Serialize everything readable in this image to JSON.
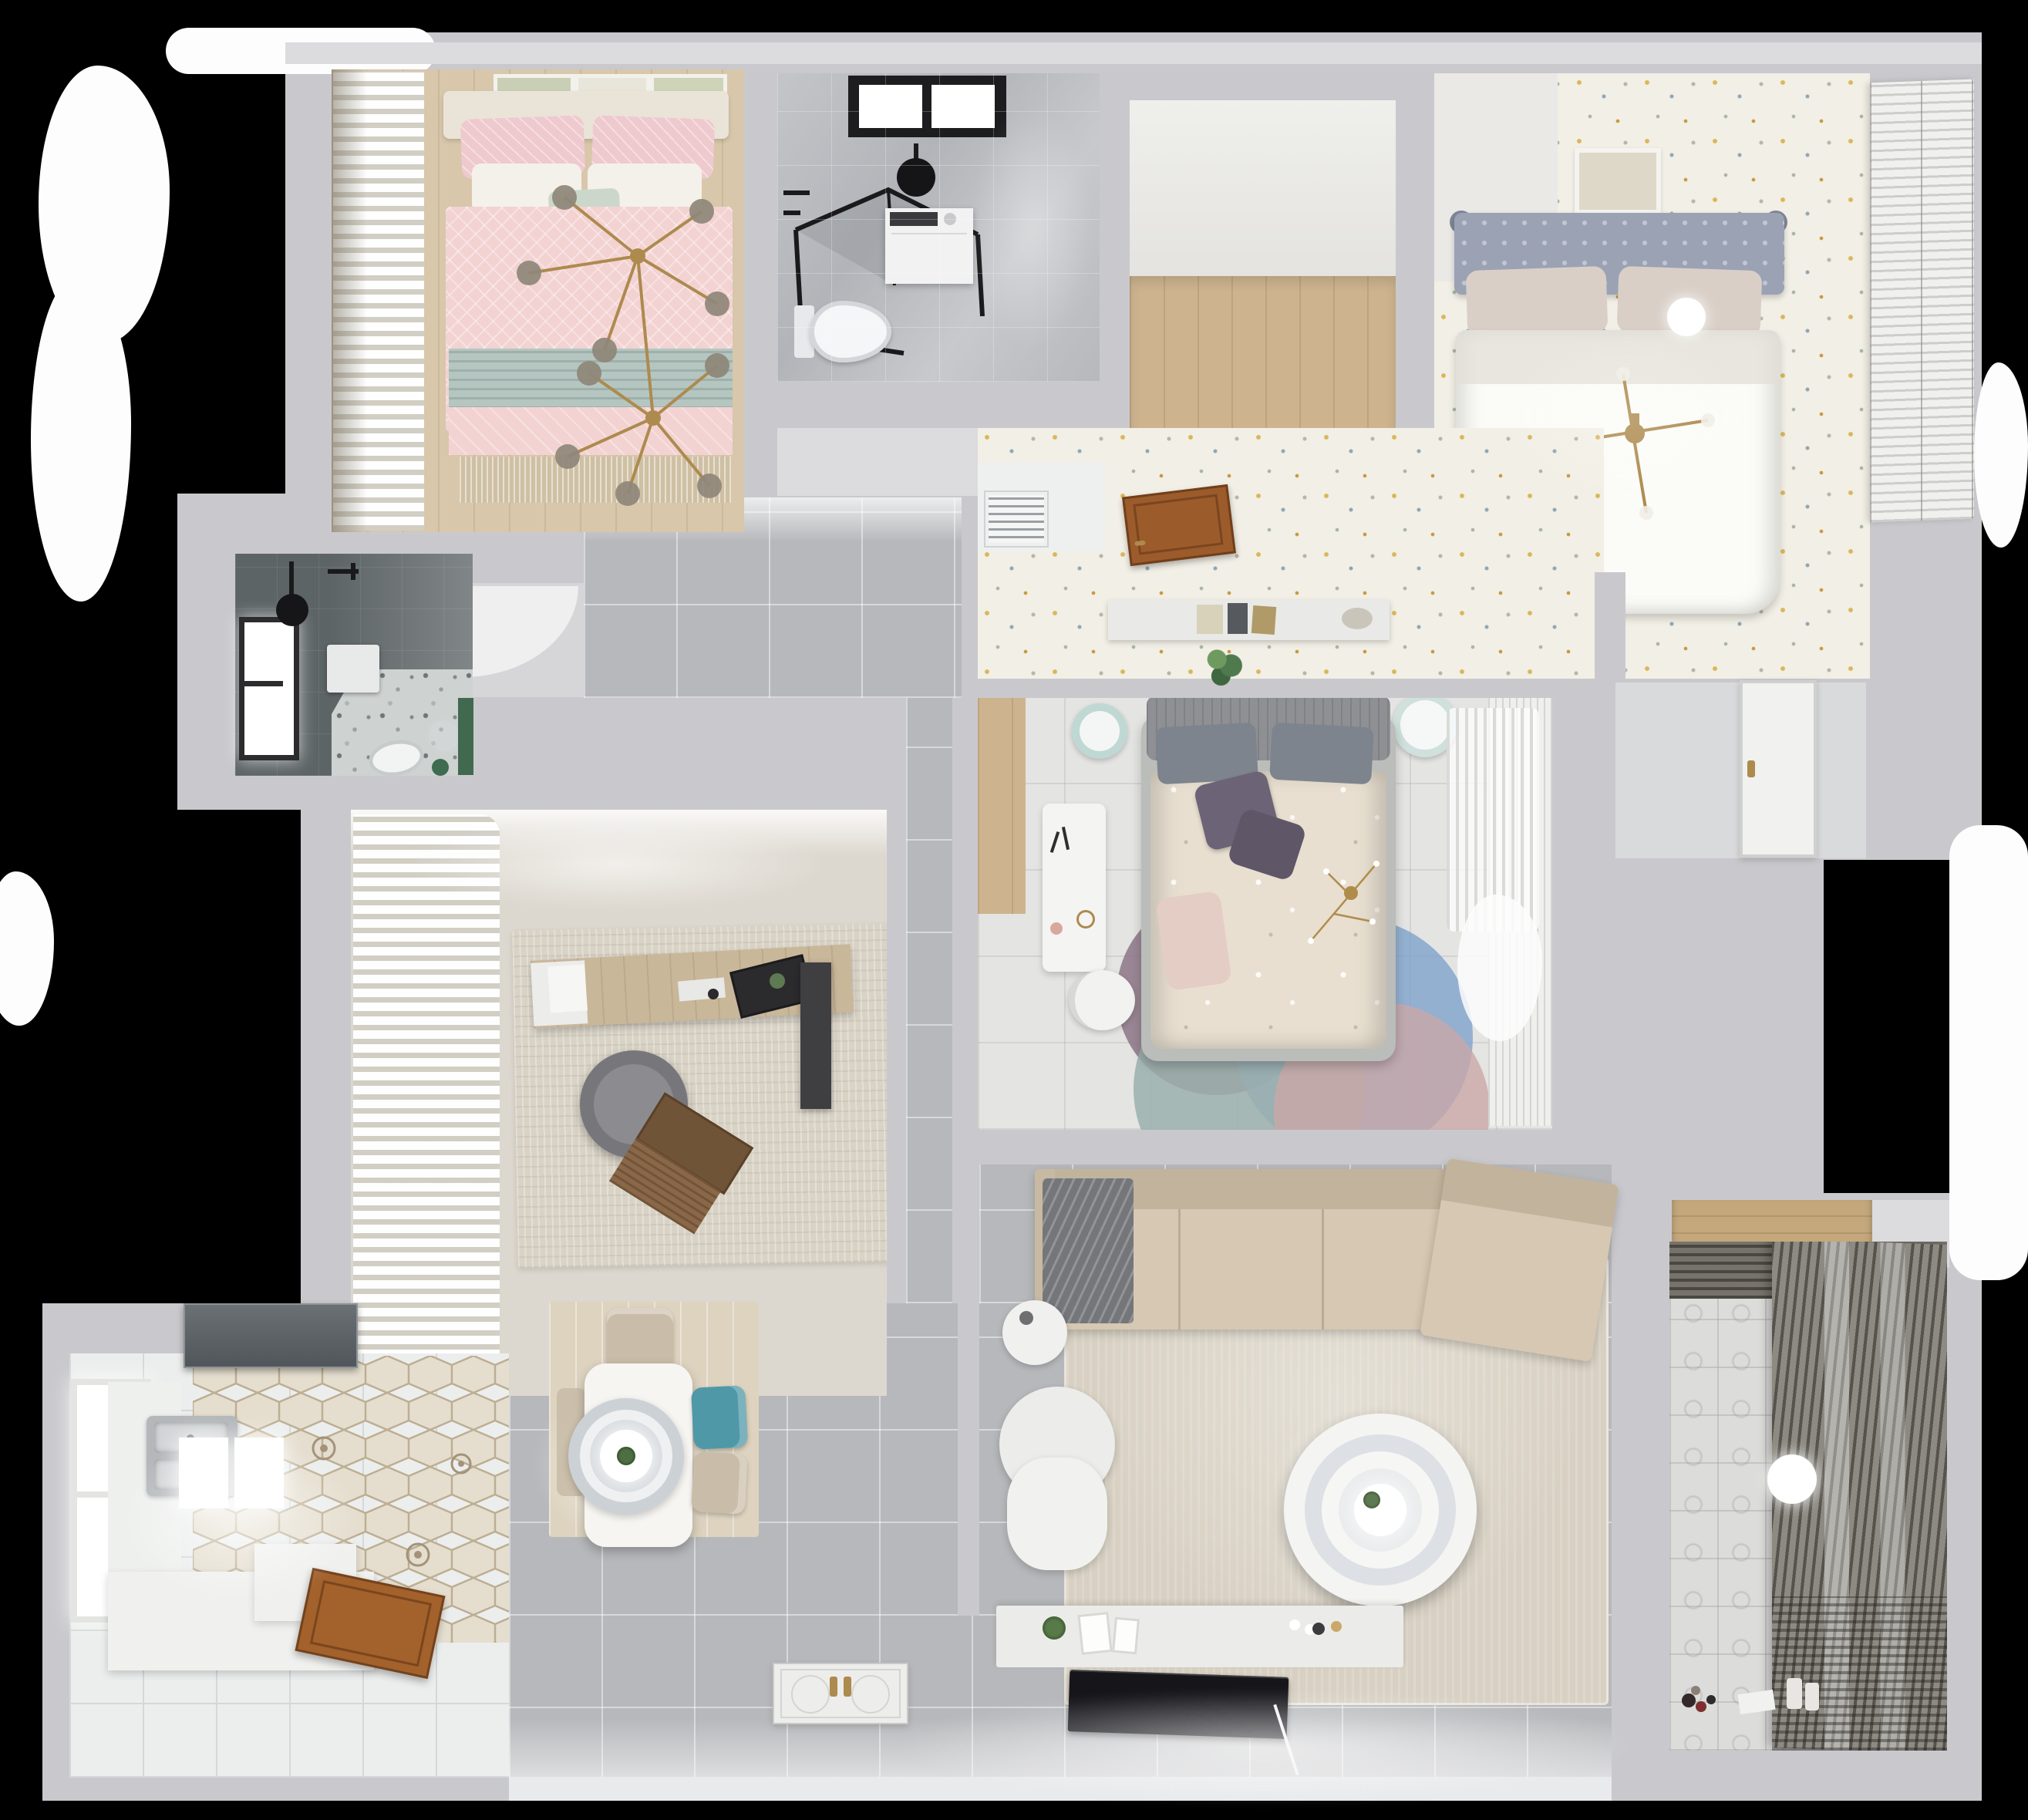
{
  "meta": {
    "title": "3D apartment floor plan, top-down render",
    "view": "top-down",
    "background": "#000000"
  },
  "colors": {
    "bg": "#000000",
    "wall": "#c9c9cd",
    "wallLight": "#dcdcdf",
    "white": "#ffffff",
    "floorGray": "#b7b8bb",
    "speckle": "#f2efe6",
    "woodMid": "#cdb48e",
    "bed1Floor": "#d8c7ab",
    "marbleBase": "#babcc0",
    "blackFrame": "#1d1d1f",
    "pink": "#f3d2d2",
    "pinkDeep": "#eec9ce",
    "tealBlanket": "#b5c6c1",
    "cream": "#f4f1ea",
    "gold": "#ad8a4e",
    "glassBulb": "#8f8779",
    "headboard2": "#9aa2b4",
    "duvet2": "#fbfbf7",
    "darkTile": "#5d6466",
    "terrazzo": "#ced2d1",
    "green": "#41694f",
    "studyFloor": "#ddd8cf",
    "studyRug": "#d9d3c6",
    "chairGray": "#77777b",
    "laptop": "#8a6747",
    "hexBase": "#e5decf",
    "hexLine": "#bdae92",
    "hood": "#565c60",
    "steel": "#b4b8bb",
    "doorWood": "#a3612c",
    "doorBrown": "#9c5b2b",
    "tealChair": "#4f98a8",
    "beigeChair": "#c9bca8",
    "diningRug": "#ddd3bf",
    "tableWhite": "#f6f5f1",
    "sofa": "#d6c8b2",
    "sofaBack": "#c2b39c",
    "throwGray": "#74767a",
    "livRug": "#d8d1c3",
    "armchair": "#ececea",
    "console": "#ebebe9",
    "tv": "#15151a",
    "balconyTile": "#dcdcda",
    "blind": "#8d8a82",
    "blindDark": "#77736b",
    "bed3Floor": "#e4e4e2",
    "bed3Duvet": "#e8dfd0",
    "purple": "#6d6376",
    "headboard3": "#8e9094",
    "pillowGray": "#7e848d",
    "rugBlue": "#7ea3cc",
    "rugMauve": "#8d7586",
    "rugTeal": "#9bb0ad",
    "rugBlush": "#caa8a8",
    "sheer": "#f4f4f2",
    "shelfWood": "#c4a87c"
  },
  "rooms": [
    {
      "id": "bedroom-pink",
      "name": "bedroom with pink bedding (top-left)",
      "furniture": [
        "double-bed",
        "pink-duvet",
        "teal-runner",
        "pillows",
        "branch-chandelier",
        "curtains",
        "wall-art-frames",
        "wood-floor"
      ]
    },
    {
      "id": "bathroom-main",
      "name": "bathroom (top-middle)",
      "furniture": [
        "window",
        "shower-head",
        "shower-enclosure",
        "washing-machine",
        "toilet",
        "marble-floor"
      ]
    },
    {
      "id": "closet-nook",
      "name": "walk-in nook with wood floor",
      "furniture": [
        "wood-floor"
      ]
    },
    {
      "id": "bedroom-master",
      "name": "bedroom with gray headboard (top-right)",
      "furniture": [
        "double-bed",
        "gray-headboard",
        "white-duvet",
        "chandelier",
        "ceiling-light",
        "wall-art",
        "shutter-wardrobe",
        "speckled-floor"
      ]
    },
    {
      "id": "hallway-upper",
      "name": "upper hallway / anteroom",
      "furniture": [
        "ac-vent",
        "open-wood-door",
        "headboard-shelf",
        "books",
        "plant",
        "speckled-floor"
      ]
    },
    {
      "id": "bathroom-dark",
      "name": "dark tiled shower room (left-middle)",
      "furniture": [
        "window",
        "shower-head",
        "cabinet",
        "toilet",
        "terrazzo-floor",
        "plant"
      ]
    },
    {
      "id": "bedroom-center",
      "name": "center bedroom",
      "furniture": [
        "double-bed",
        "purple-pillows",
        "floral-duvet",
        "desk",
        "desk-chair",
        "stool-left",
        "stool-right",
        "round-layered-rug",
        "sheer-curtain",
        "wardrobe"
      ]
    },
    {
      "id": "study",
      "name": "study / office (middle-left)",
      "furniture": [
        "curtains",
        "desk",
        "monitor",
        "office-chair",
        "laptop",
        "area-rug",
        "doormat",
        "bookcase"
      ]
    },
    {
      "id": "kitchen",
      "name": "kitchen (bottom-left)",
      "furniture": [
        "range-hood",
        "double-sink",
        "window",
        "counters",
        "hex-tile-floor",
        "wood-door"
      ]
    },
    {
      "id": "dining",
      "name": "dining area",
      "furniture": [
        "dining-table",
        "pendant-lamp",
        "teal-chair",
        "beige-chairs",
        "wood-rug"
      ]
    },
    {
      "id": "living",
      "name": "living room",
      "furniture": [
        "sectional-sofa",
        "throw-blanket",
        "area-rug",
        "round-coffee-table",
        "armchair",
        "side-table",
        "tv-console",
        "flat-tv",
        "front-door"
      ]
    },
    {
      "id": "balcony",
      "name": "balcony / laundry (bottom-right)",
      "furniture": [
        "patterned-tile-floor",
        "blinds-drying-rack",
        "ceiling-light",
        "toys",
        "wood-shelf"
      ]
    }
  ]
}
